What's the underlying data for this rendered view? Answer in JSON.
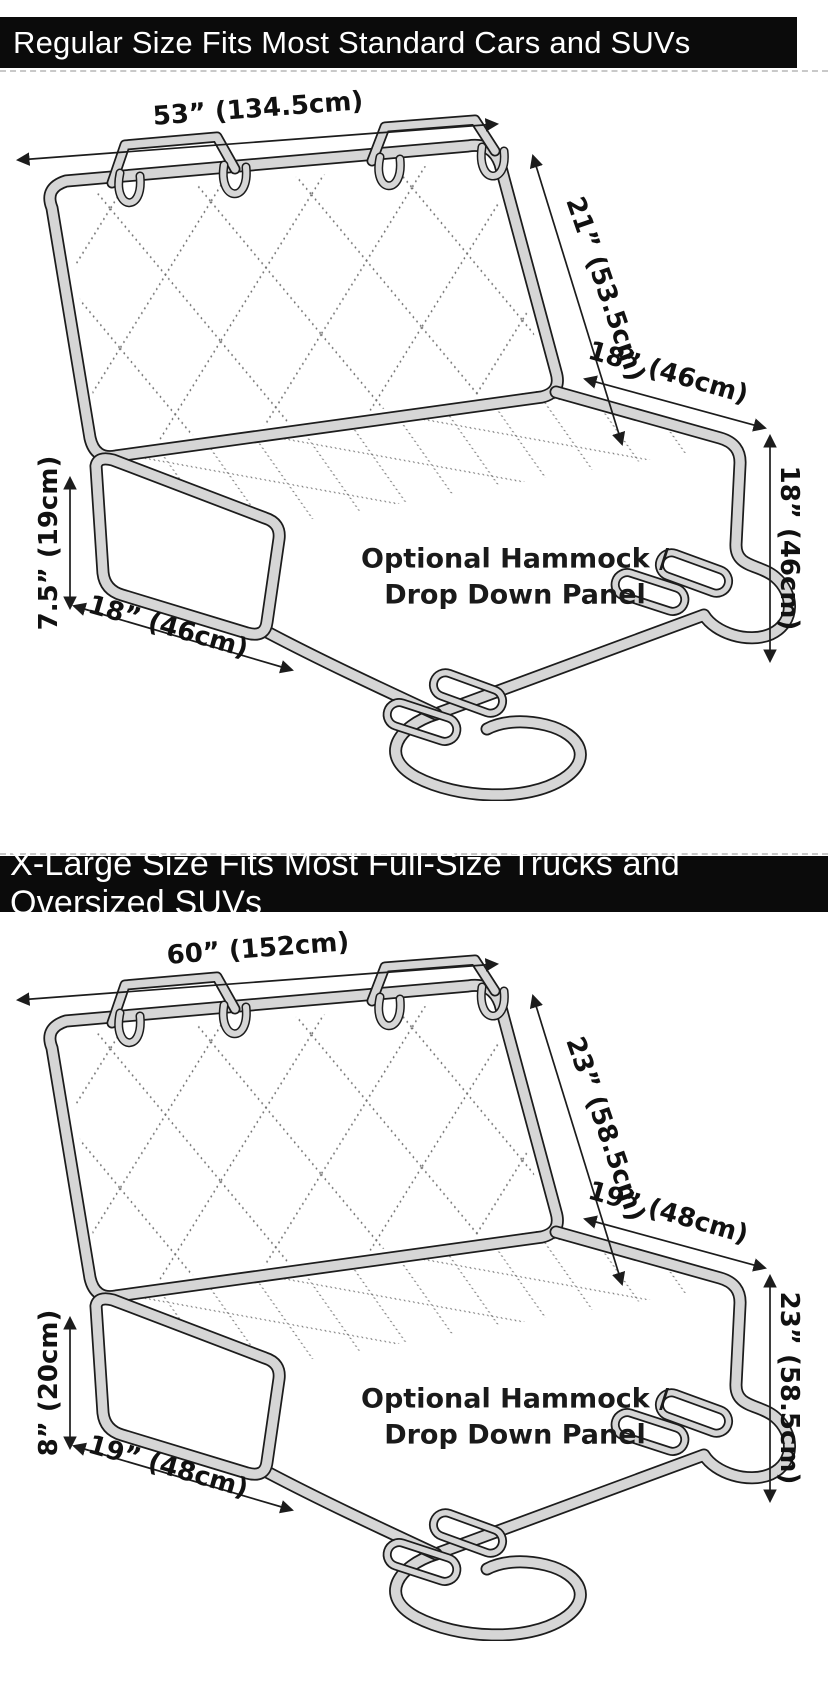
{
  "colors": {
    "banner_bg": "#0b0b0b",
    "banner_text": "#ffffff",
    "outline": "#1c1c1c",
    "band_fill": "#d6d6d6",
    "quilt_dot": "#6f6f6f",
    "label_text": "#111111"
  },
  "sections": [
    {
      "banner": "Regular Size Fits Most Standard Cars and SUVs",
      "hammock_note": "Optional Hammock /\nDrop Down Panel",
      "dimensions": {
        "top_width": "53” (134.5cm)",
        "back_height": "21” (53.5cm)",
        "seat_depth": "18” (46cm)",
        "side_drop": "18” (46cm)",
        "flap_height": "7.5” (19cm)",
        "flap_width": "18” (46cm)"
      }
    },
    {
      "banner": "X-Large Size Fits Most Full-Size Trucks and Oversized SUVs",
      "hammock_note": "Optional Hammock /\nDrop Down Panel",
      "dimensions": {
        "top_width": "60” (152cm)",
        "back_height": "23” (58.5cm)",
        "seat_depth": "19” (48cm)",
        "side_drop": "23” (58.5cm)",
        "flap_height": "8” (20cm)",
        "flap_width": "19” (48cm)"
      }
    }
  ]
}
